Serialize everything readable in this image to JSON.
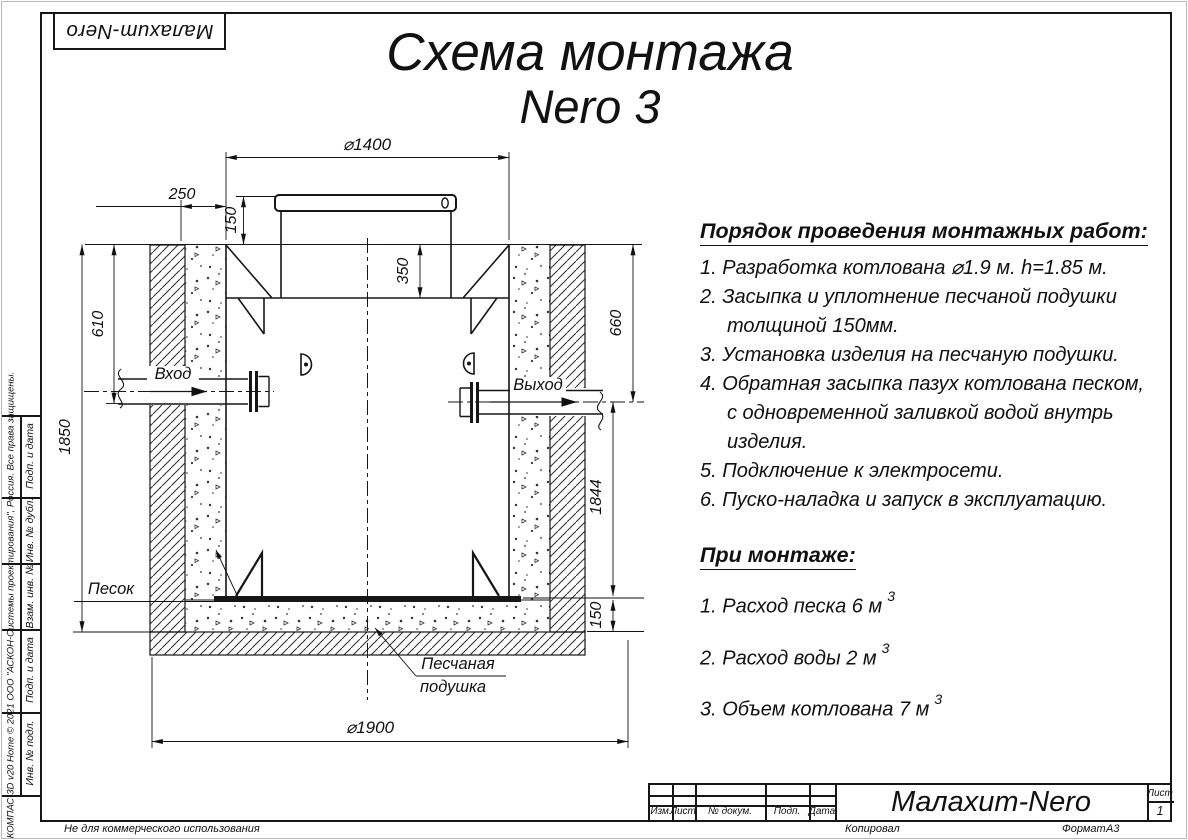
{
  "logo": "Малахит-Nero",
  "title": {
    "line1": "Схема монтажа",
    "line2": "Nero 3"
  },
  "instructions": {
    "heading": "Порядок проведения монтажных работ:",
    "lines": [
      {
        "text": "1. Разработка котлована ⌀1.9 м. h=1.85 м.",
        "indent": false
      },
      {
        "text": "2. Засыпка и уплотнение песчаной подушки",
        "indent": false
      },
      {
        "text": "толщиной 150мм.",
        "indent": true
      },
      {
        "text": "3. Установка изделия на песчаную подушки.",
        "indent": false
      },
      {
        "text": "4. Обратная засыпка пазух котлована песком,",
        "indent": false
      },
      {
        "text": "с одновременной заливкой водой внутрь",
        "indent": true
      },
      {
        "text": "изделия.",
        "indent": true
      },
      {
        "text": "5. Подключение к электросети.",
        "indent": false
      },
      {
        "text": "6. Пуско-наладка и запуск в эксплуатацию.",
        "indent": false
      }
    ]
  },
  "montage": {
    "heading": "При монтаже:",
    "items": [
      {
        "text": "1. Расход песка 6 м",
        "sup": "3"
      },
      {
        "text": "2. Расход воды 2 м",
        "sup": "3"
      },
      {
        "text": "3. Объем котлована 7 м",
        "sup": "3"
      }
    ]
  },
  "drawing": {
    "labels": {
      "inlet": "Вход",
      "outlet": "Выход",
      "sand": "Песок",
      "cushion1": "Песчаная",
      "cushion2": "подушка"
    },
    "dims": {
      "d1400": "⌀1400",
      "d250": "250",
      "d150top": "150",
      "d350": "350",
      "d610": "610",
      "d1850": "1850",
      "d660": "660",
      "d1844": "1844",
      "d150bottom": "150",
      "d1900": "⌀1900"
    }
  },
  "titleblock": {
    "col_izm": "Изм.",
    "col_list": "Лист",
    "col_doc": "№ докум.",
    "col_podp": "Подп.",
    "col_data": "Дата",
    "product": "Малахит-Nero",
    "sheet_label": "Лист",
    "sheet_number": "1",
    "copied": "Копировал",
    "format_label": "Формат",
    "format_value": "А3"
  },
  "stamp": {
    "cells": [
      "Подп. и дата",
      "Инв. № дубл.",
      "Взам. инв. №",
      "Подп. и дата",
      "Инв. № подл."
    ],
    "software": "КОМПАС-3D v20 Home © 2021 ООО \"АСКОН-Системы проектирования\", Россия. Все права защищены.",
    "notice": "Не для коммерческого использования"
  },
  "colors": {
    "line": "#161616",
    "paper": "#ffffff"
  }
}
